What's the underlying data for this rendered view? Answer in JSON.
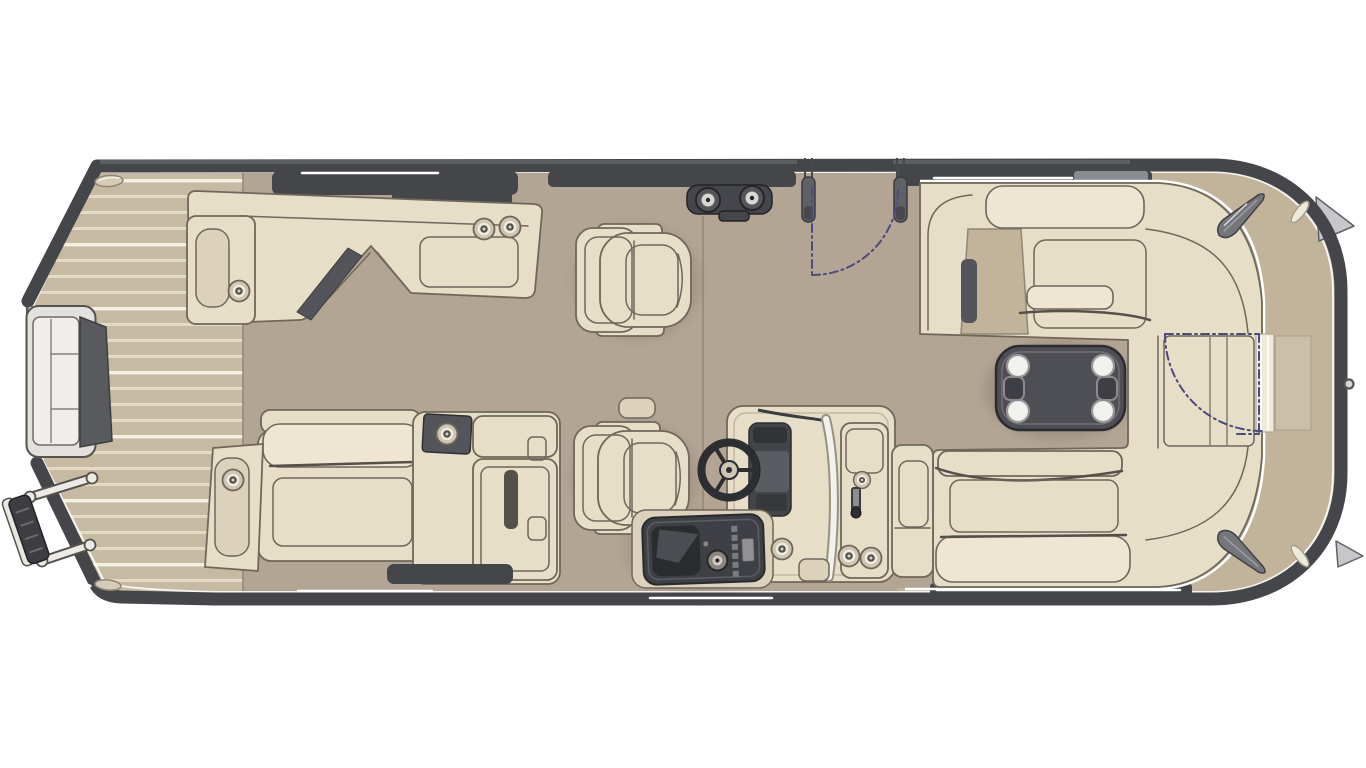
{
  "canvas": {
    "width": 1366,
    "height": 768,
    "background": "#ffffff"
  },
  "colors": {
    "background": "#ffffff",
    "hull_rim": "#45464a",
    "hull_edge": "#55565a",
    "floor": "#b3a593",
    "gunwale_band": "#c2b49b",
    "plank_base": "#c6baa2",
    "plank_stripe": "#e2dbc6",
    "plank_stripe_bright": "#f4f0e2",
    "cushion": "#e7dec8",
    "cushion_light": "#eee6d2",
    "cushion_mid": "#dcd1ba",
    "cushion_outline": "#6f675a",
    "seam_dark": "#55504a",
    "fitting_dark": "#45464b",
    "fitting_mid": "#75767b",
    "metal_light": "#d9d7d3",
    "console_dark": "#3f4045",
    "table_top": "#4e4f54",
    "table_edge": "#2b2c30",
    "table_line": "#707175",
    "white_accent": "#ffffff",
    "swing_arc": "#4c4a7e",
    "windshield": "#f2f1ee"
  },
  "diagram": {
    "type": "floorplan",
    "subject": "pontoon boat deck plan, top view, bow at left and stern at right",
    "zones": [
      {
        "name": "bow-deck",
        "parts": [
          "teak-plank-flooring",
          "bow-boarding-gate",
          "boarding-ladder",
          "bow-light-port",
          "bow-light-starboard",
          "corner-trim-accents"
        ]
      },
      {
        "name": "forward-lounges",
        "parts": [
          "port-chaise-lounge",
          "port-armrest-cup-holder",
          "chaise-cup-holders",
          "port-chaise-dark-pad",
          "starboard-bench-lounge",
          "starboard-armrest-cup-holder",
          "storage-console-cup-holder",
          "bench-side-tabs"
        ]
      },
      {
        "name": "midship",
        "parts": [
          "captain-chair-port",
          "captain-chair-starboard",
          "helm-console",
          "steering-wheel",
          "dashboard",
          "windshield",
          "helm-side-gate",
          "gate-latch",
          "helm-cup-holders",
          "cooler-console",
          "cooler-knob",
          "cooler-buttons",
          "deck-cup-holder",
          "port-gate-posts",
          "port-gate-swing-arc",
          "ski-tow-cleat"
        ]
      },
      {
        "name": "stern-lounge",
        "parts": [
          "wraparound-lounge",
          "backrest-pillows",
          "lounge-recessed-tray",
          "lounge-dark-slots",
          "removable-table",
          "table-cup-holders",
          "table-handles",
          "stern-gate",
          "stern-gate-swing-arc",
          "stern-corner-pads",
          "stern-vents",
          "mooring-cleats",
          "stern-tie-ring",
          "gunwale-band"
        ]
      }
    ]
  }
}
